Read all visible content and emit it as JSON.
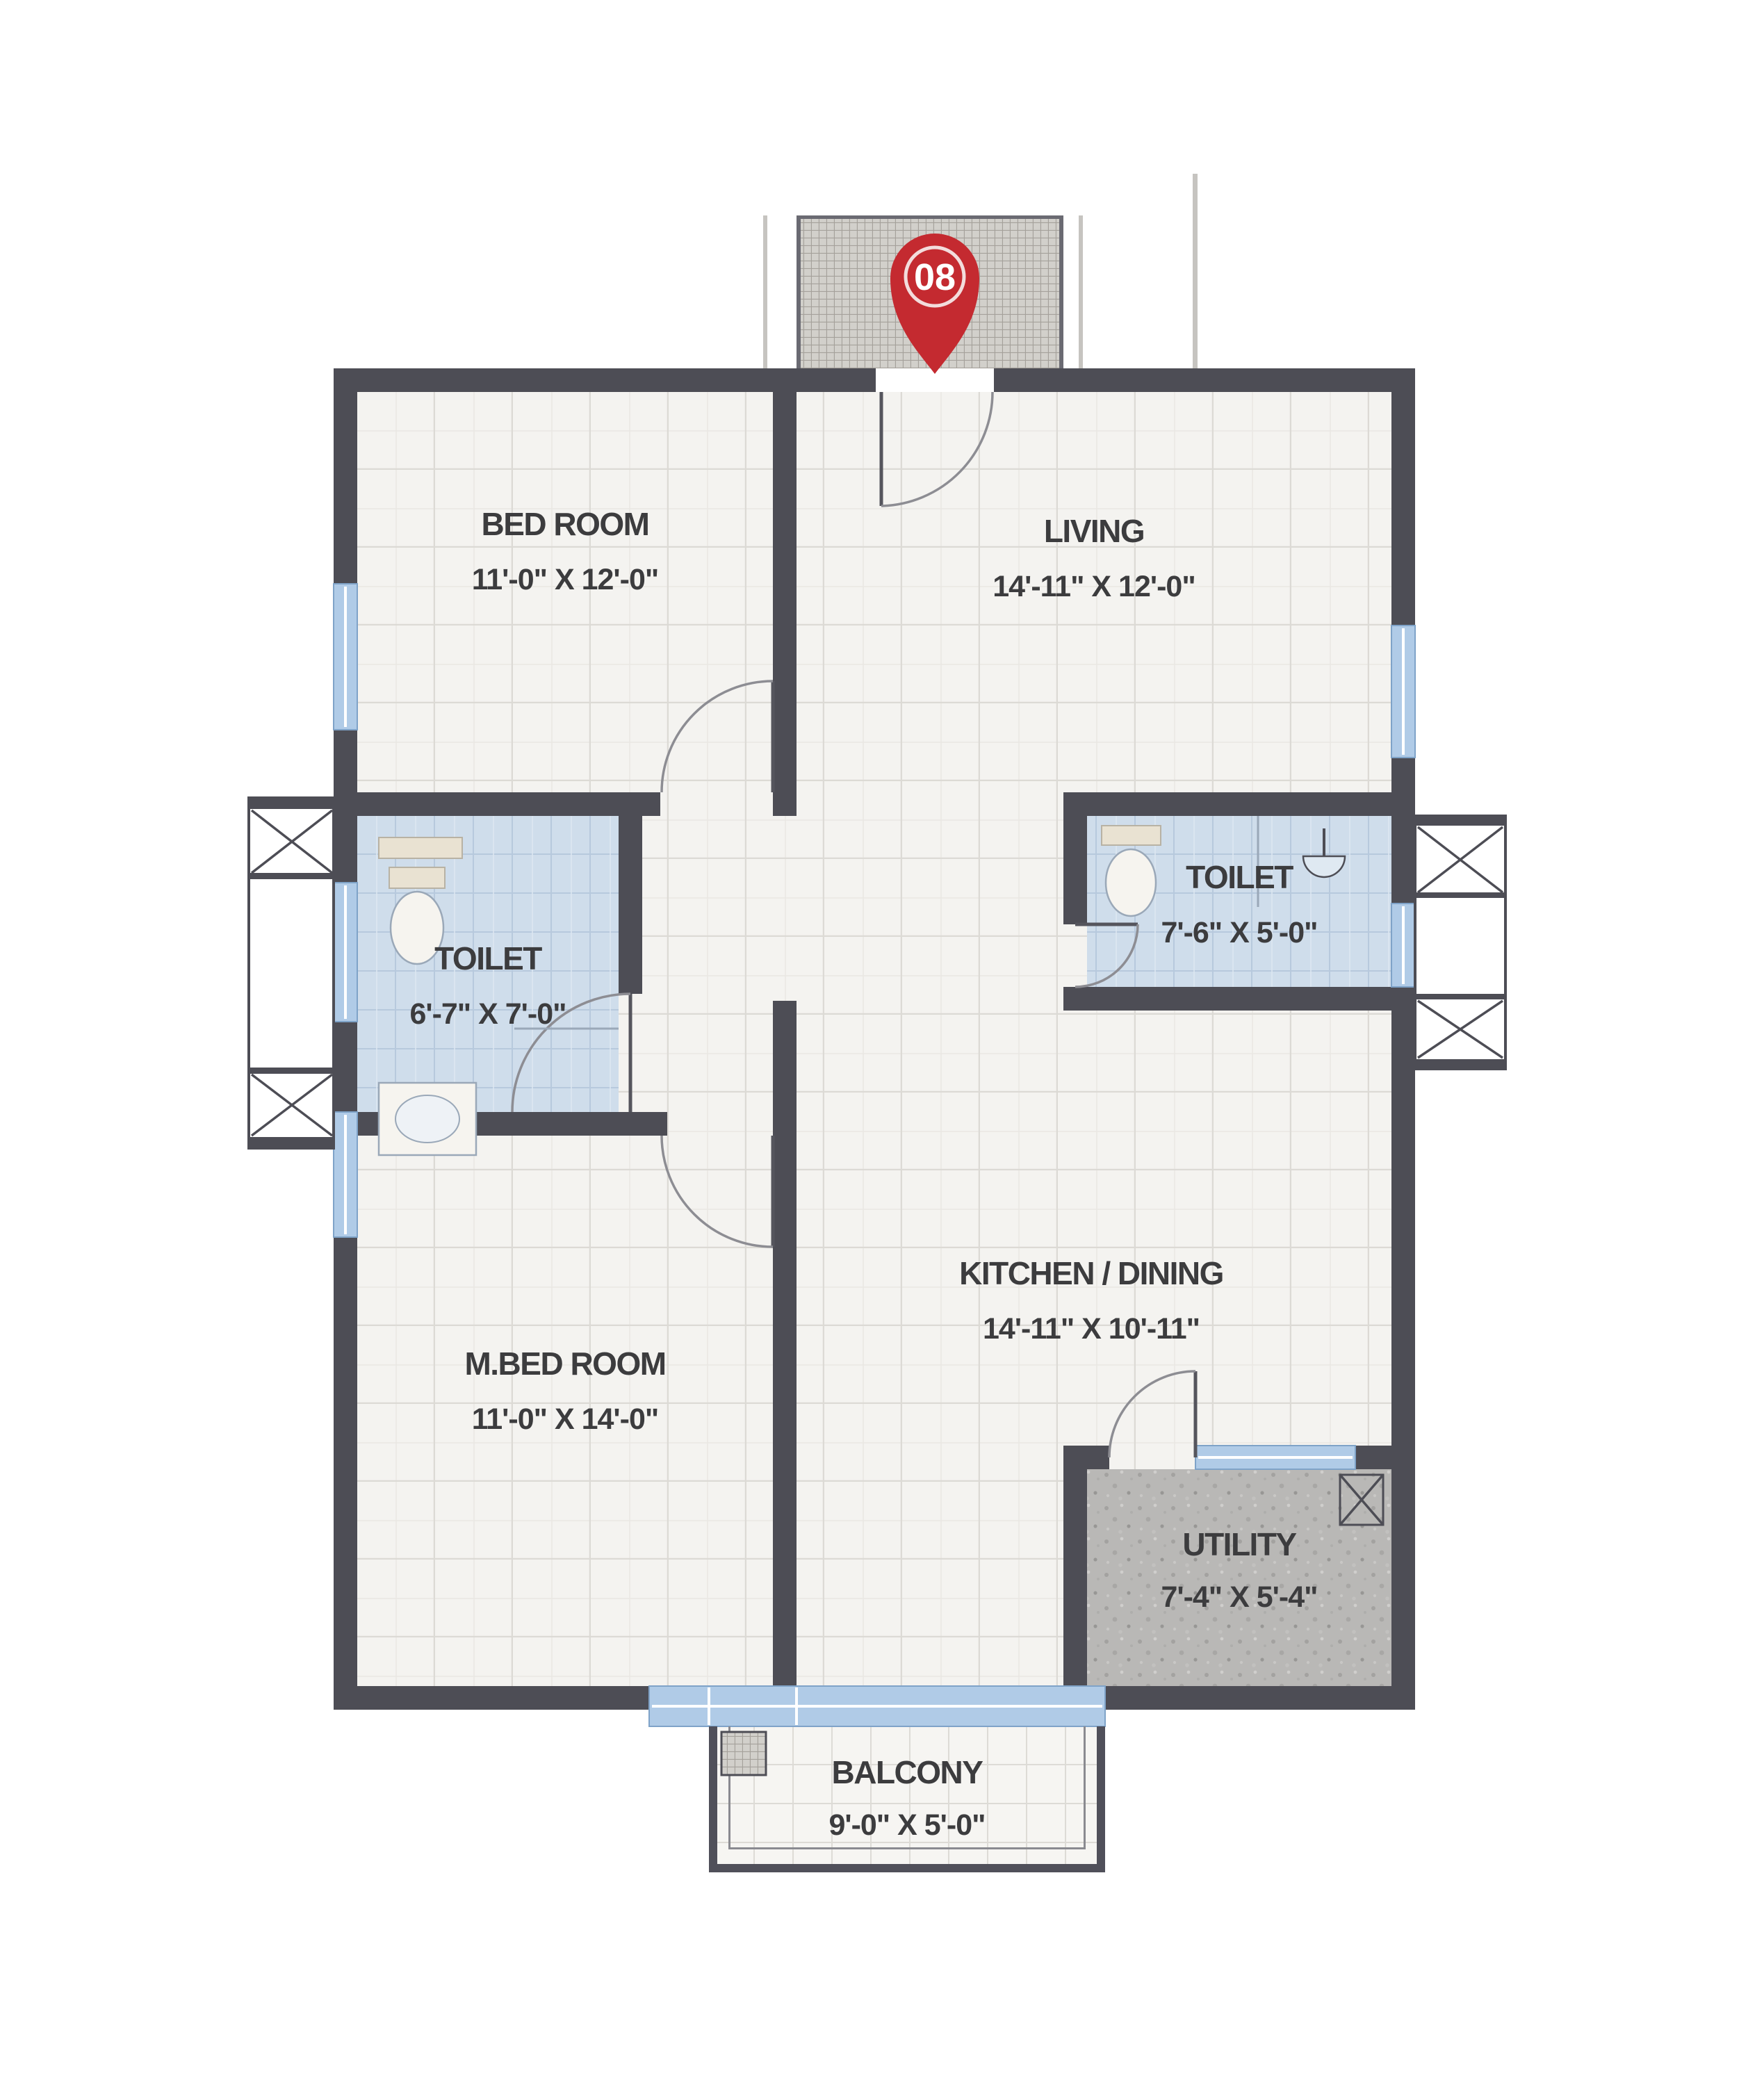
{
  "plan": {
    "title": "Unit floor plan",
    "unit_number": "08",
    "rooms": [
      {
        "key": "bedroom",
        "name": "BED ROOM",
        "dimensions": "11'-0\" X 12'-0\""
      },
      {
        "key": "living",
        "name": "LIVING",
        "dimensions": "14'-11\" X 12'-0\""
      },
      {
        "key": "toilet_left",
        "name": "TOILET",
        "dimensions": "6'-7\" X 7'-0\""
      },
      {
        "key": "toilet_right",
        "name": "TOILET",
        "dimensions": "7'-6\" X 5'-0\""
      },
      {
        "key": "master_bedroom",
        "name": "M.BED ROOM",
        "dimensions": "11'-0\" X 14'-0\""
      },
      {
        "key": "kitchen_dining",
        "name": "KITCHEN / DINING",
        "dimensions": "14'-11\" X 10'-11\""
      },
      {
        "key": "utility",
        "name": "UTILITY",
        "dimensions": "7'-4\" X 5'-4\""
      },
      {
        "key": "balcony",
        "name": "BALCONY",
        "dimensions": "9'-0\" X 5'-0\""
      }
    ],
    "colors": {
      "wall": "#4d4d55",
      "floor": "#f4f3f0",
      "floor_grid": "#dcdad5",
      "toilet_floor": "#cfddeb",
      "utility_floor": "#b9b8b6",
      "window": "#b0cbe7",
      "entrance_hatch": "#d2d0cb",
      "unit_badge": "#c42a30",
      "label_text": "#3c3c3e"
    }
  }
}
